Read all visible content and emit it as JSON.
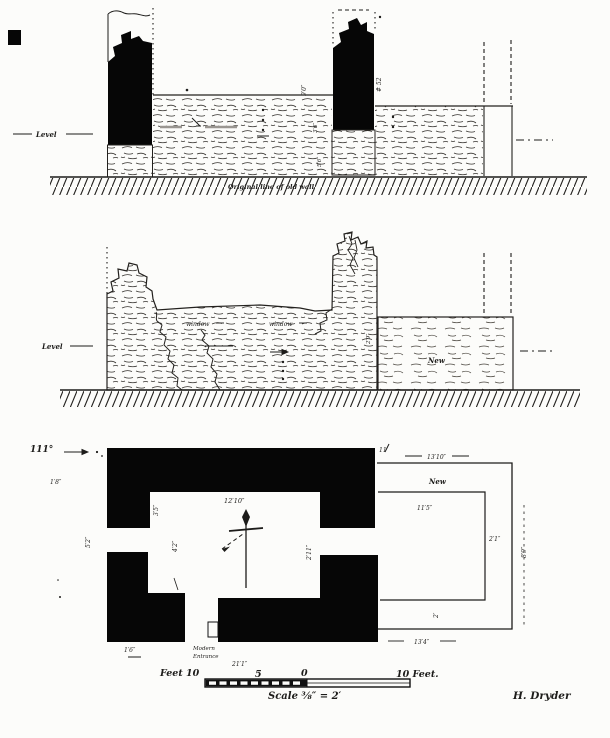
{
  "upper_elevation": {
    "level_label": "Level",
    "ground_caption": "Original line of old wall",
    "dim_pier_height": "9′0″",
    "pier_number": "# 52",
    "dim_base_small": "3′6″",
    "dim_base_large": "5′6″"
  },
  "middle_elevation": {
    "level_label": "Level",
    "window_left_label": "window",
    "window_right_label": "window",
    "new_wall_label": "New",
    "dim_pier": "2′9″"
  },
  "plan": {
    "angle_label": "111°",
    "dim_wall_top_left": "1′8″",
    "dim_left_opening": "5′2″",
    "dim_left_wall_upper": "3′5″",
    "dim_left_wall_lower": "4′2″",
    "dim_interior_width": "12′10″",
    "dim_east_opening": "2′11″",
    "dim_north_gap": "11′",
    "dim_new_outer_width": "13′10″",
    "new_label": "New",
    "dim_new_inner_width": "11′5″",
    "dim_new_wall_thickness": "2′1″",
    "dim_new_right": "8′9″",
    "dim_new_bottom_gap": "2′",
    "dim_new_outer_bottom": "13′4″",
    "dim_entrance_width": "1′6″",
    "entrance_label_line1": "Modern",
    "entrance_label_line2": "Entrance",
    "dim_overall": "21′1″"
  },
  "scale_bar": {
    "left_label": "Feet 10",
    "mid_label": "5",
    "zero_label": "0",
    "right_label": "10 Feet.",
    "scale_text": "Scale ⅜″ = 2′"
  },
  "signature": "H. Dryder",
  "colors": {
    "ink": "#1d1c1a",
    "wall_fill": "#060606",
    "paper": "#fcfcfa"
  }
}
